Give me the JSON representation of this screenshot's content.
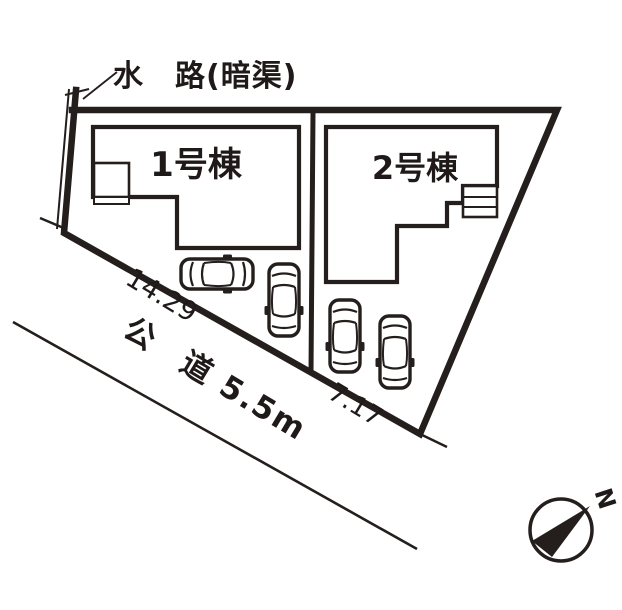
{
  "page": {
    "background": "#ffffff",
    "ink": "#241e1c"
  },
  "plan": {
    "waterway_label": "水　路(暗渠)",
    "house1_label": "1号棟",
    "house2_label": "2号棟",
    "road_label": "公　道 5.5m",
    "frontage1": "14.29",
    "frontage2": "7.17",
    "compass_north": "N"
  }
}
